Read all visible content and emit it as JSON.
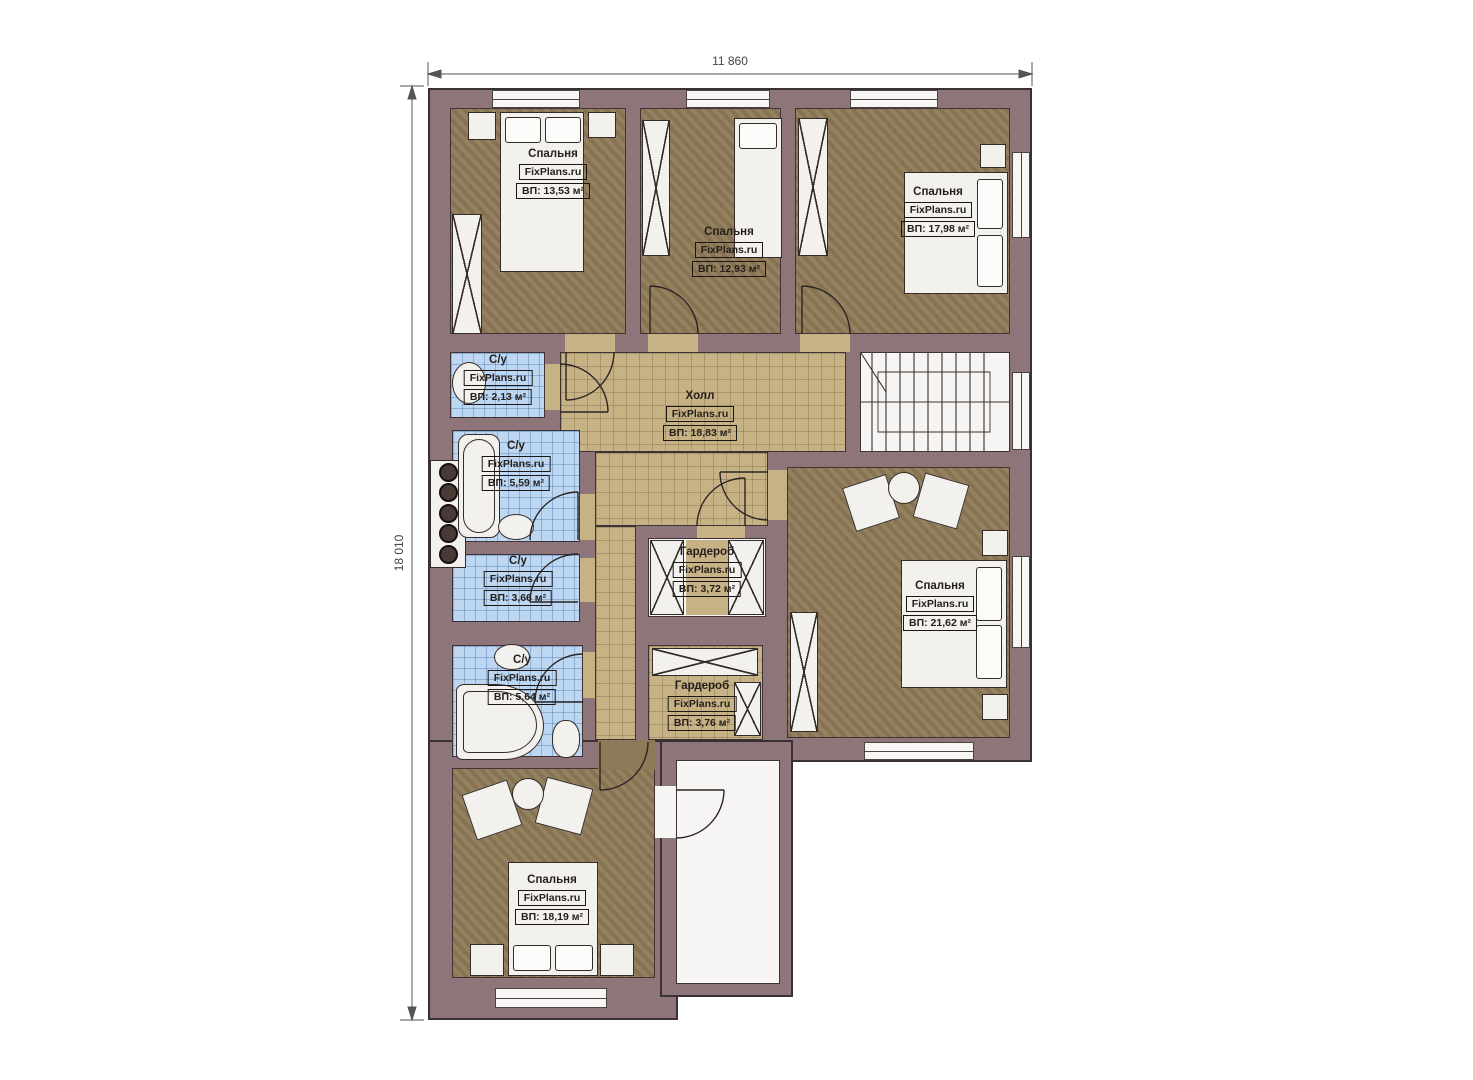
{
  "plan": {
    "title": "Поэтажный план — второй этаж",
    "dimensions": {
      "width": "11 860",
      "height": "18 010"
    },
    "watermark": "FixPlans.ru",
    "rooms": [
      {
        "id": "bedroom-top-left",
        "name": "Спальня",
        "brand": "FixPlans.ru",
        "area": "ВП: 13,53 м²"
      },
      {
        "id": "bedroom-top-middle",
        "name": "Спальня",
        "brand": "FixPlans.ru",
        "area": "ВП: 12,93 м²"
      },
      {
        "id": "bedroom-top-right",
        "name": "Спальня",
        "brand": "FixPlans.ru",
        "area": "ВП: 17,98 м²"
      },
      {
        "id": "hall",
        "name": "Холл",
        "brand": "FixPlans.ru",
        "area": "ВП: 18,83 м²"
      },
      {
        "id": "bathroom-small",
        "name": "С/у",
        "brand": "FixPlans.ru",
        "area": "ВП: 2,13 м²"
      },
      {
        "id": "bathroom-main",
        "name": "С/у",
        "brand": "FixPlans.ru",
        "area": "ВП: 5,59 м²"
      },
      {
        "id": "bathroom-middle",
        "name": "С/у",
        "brand": "FixPlans.ru",
        "area": "ВП: 3,66 м²"
      },
      {
        "id": "bathroom-lower",
        "name": "С/у",
        "brand": "FixPlans.ru",
        "area": "ВП: 5,64 м²"
      },
      {
        "id": "wardrobe-upper",
        "name": "Гардероб",
        "brand": "FixPlans.ru",
        "area": "ВП: 3,72 м²"
      },
      {
        "id": "wardrobe-lower",
        "name": "Гардероб",
        "brand": "FixPlans.ru",
        "area": "ВП: 3,76 м²"
      },
      {
        "id": "bedroom-right",
        "name": "Спальня",
        "brand": "FixPlans.ru",
        "area": "ВП: 21,62 м²"
      },
      {
        "id": "bedroom-bottom",
        "name": "Спальня",
        "brand": "FixPlans.ru",
        "area": "ВП: 18,19 м²"
      }
    ],
    "colors": {
      "wall": "#8d757a",
      "bedroom_floor": "#8e7a58",
      "hall_floor": "#c7b286",
      "bath_floor": "#bdd7f2",
      "fixture": "#f2f1ee"
    }
  }
}
